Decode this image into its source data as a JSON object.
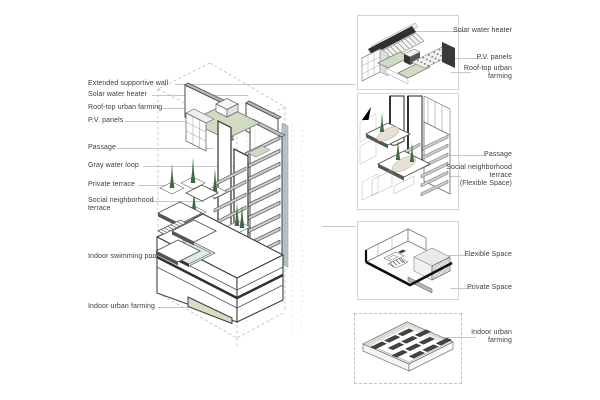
{
  "main_drawing": {
    "description": "axonometric tower building",
    "left_labels": [
      "Extended supportive wall",
      "Solar water heater",
      "Roof-top urban farming",
      "P.V. panels",
      "Passage",
      "Gray water loop",
      "Private terrace",
      "Social neighborhood\nterrace",
      "Indoor swimming pool",
      "Indoor urban farming"
    ]
  },
  "detail_views": [
    {
      "name": "roof-systems-detail",
      "labels": [
        "Solar water heater",
        "P.V. panels",
        "Roof-top urban\nfarming"
      ]
    },
    {
      "name": "terrace-passage-detail",
      "labels": [
        "Passage",
        "Social neighborhood\nterrace\n(Flexible Space)"
      ]
    },
    {
      "name": "unit-interior-detail",
      "labels": [
        "Flexible Space",
        "Private Space"
      ]
    },
    {
      "name": "indoor-farming-detail",
      "labels": [
        "Indoor urban\nfarming"
      ]
    }
  ],
  "colors": {
    "roof_farming_green": "#cfdcc3",
    "tree_green": "#3e6b43",
    "pool_blue": "#dcebe9",
    "indoor_farming_green": "#d5dec4",
    "slab_gray": "#c9c9c9",
    "gray_water_loop_band": "#b9c6cb",
    "outline_dark": "#3f3f3f",
    "leader_line_gray": "#c6c6c6",
    "text": "#3c3c3c"
  }
}
